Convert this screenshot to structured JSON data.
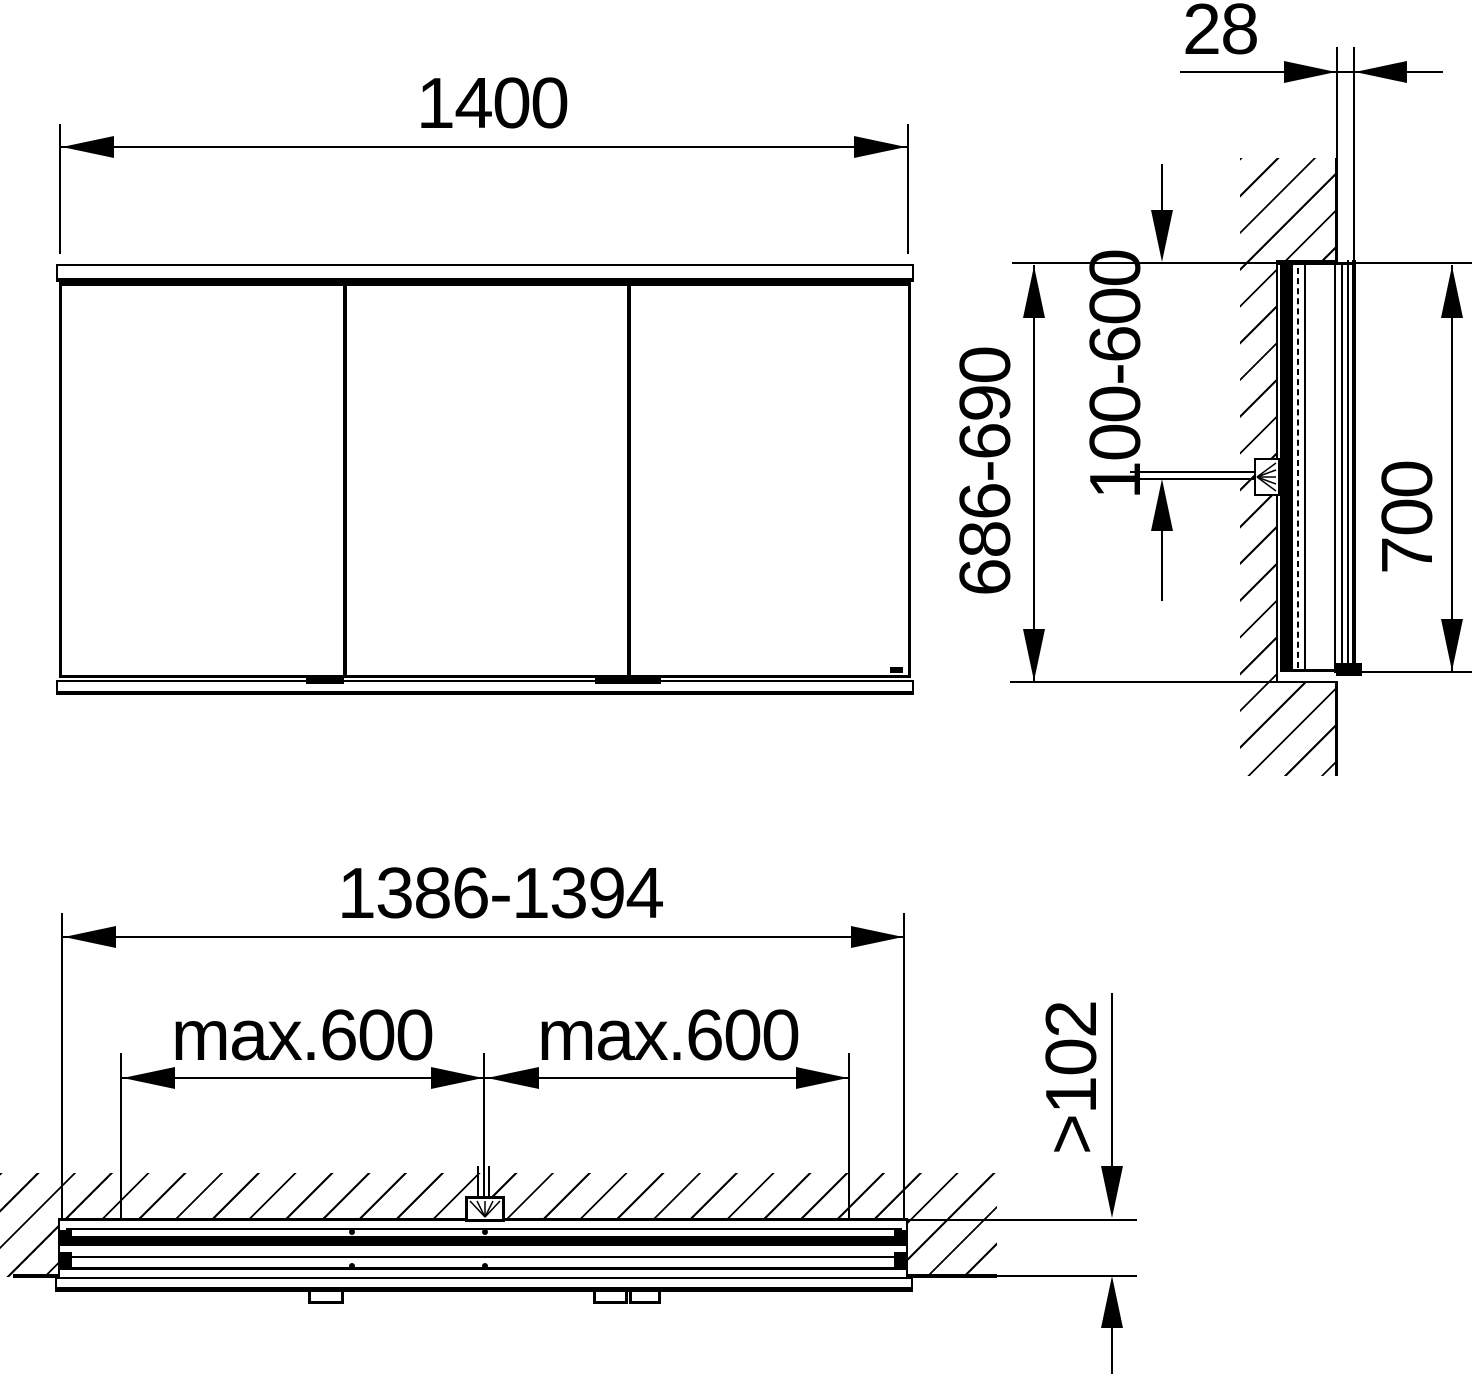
{
  "drawing": {
    "background": "#ffffff",
    "line_color": "#000000",
    "views": {
      "front": {
        "width": "1400"
      },
      "side": {
        "protrusion_depth": "28",
        "niche_height": "686-690",
        "connection_height": "100-600",
        "cabinet_height": "700"
      },
      "plan": {
        "niche_width": "1386-1394",
        "max_left": "max.600",
        "max_right": "max.600",
        "niche_depth": ">102"
      }
    }
  }
}
